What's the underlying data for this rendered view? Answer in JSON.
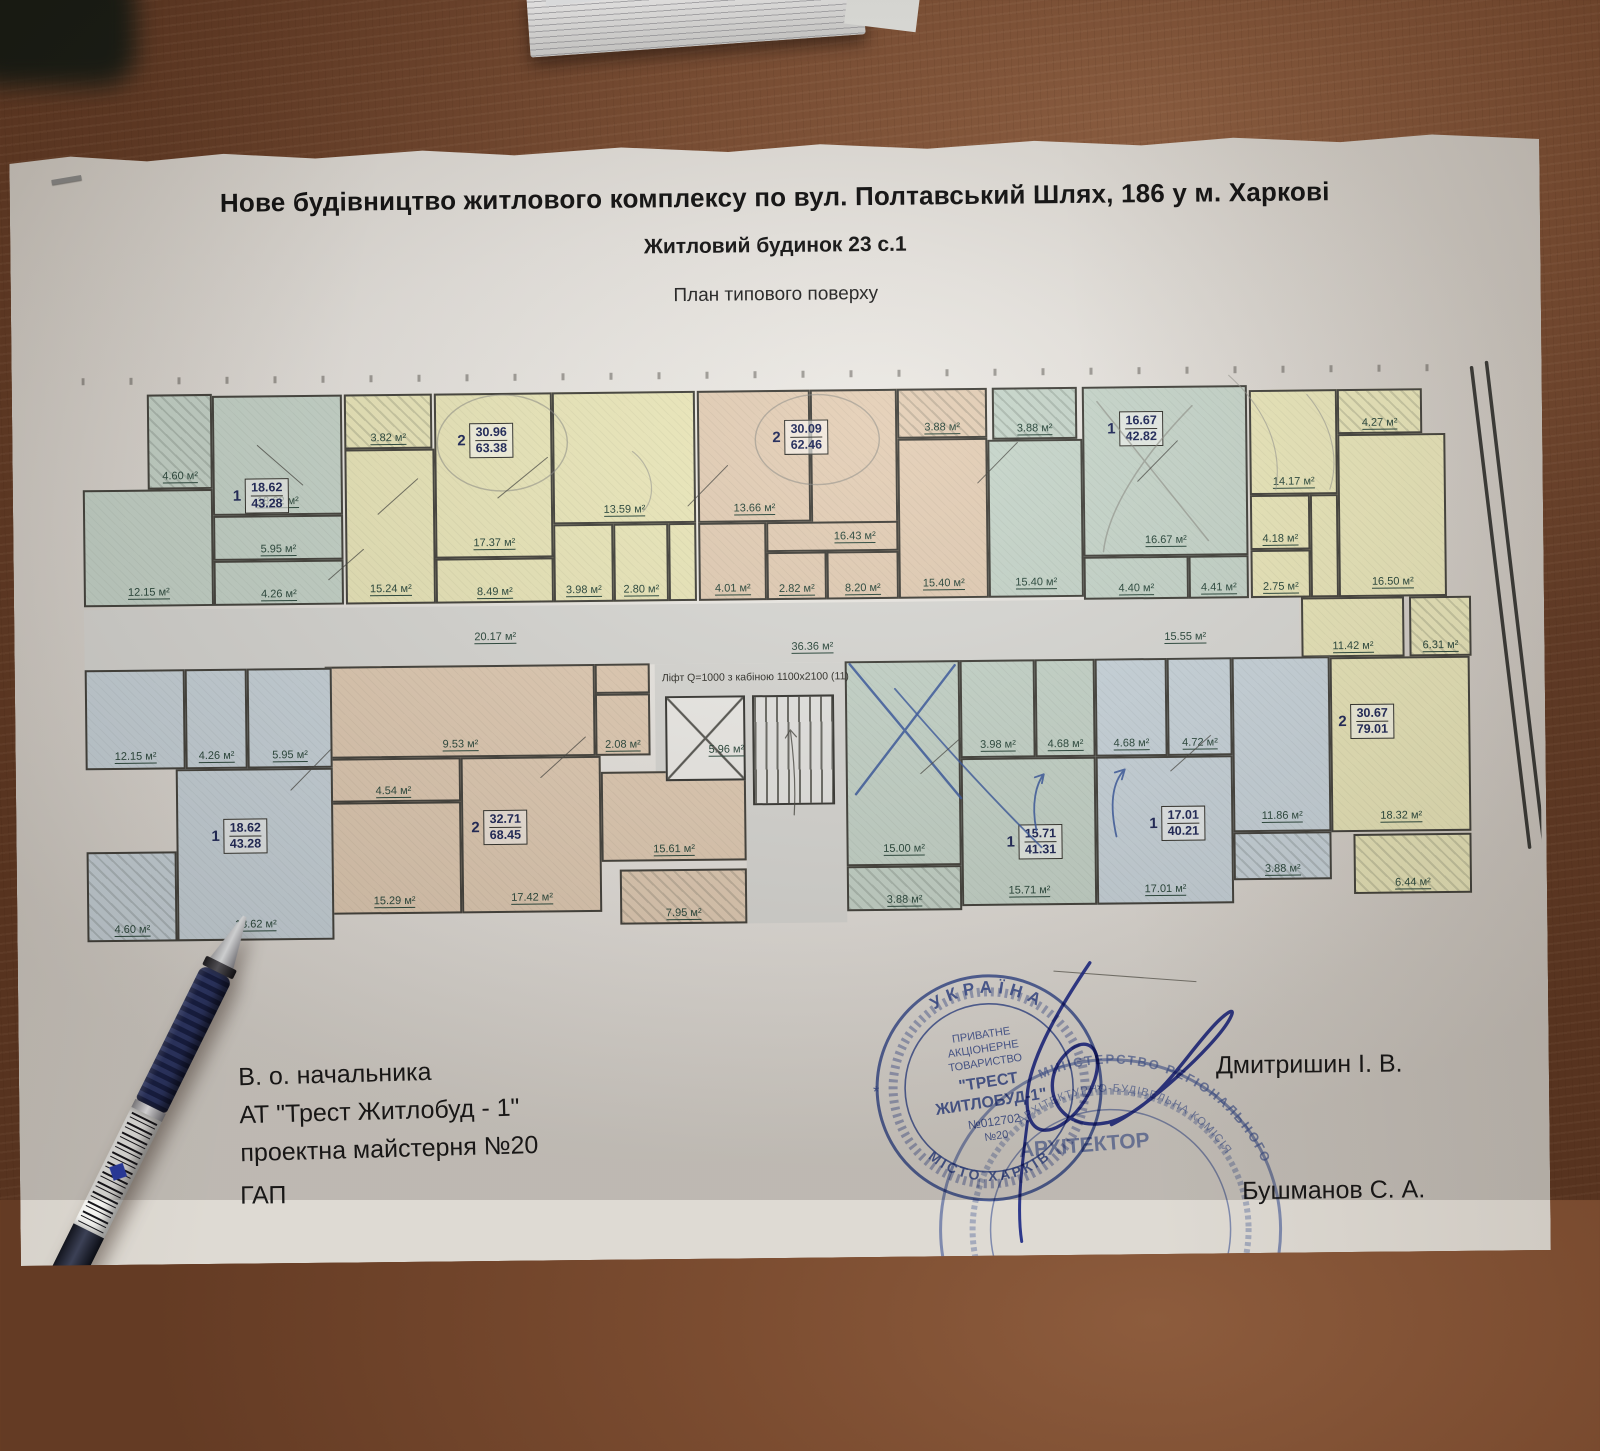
{
  "titles": {
    "line1": "Нове будівництво житлового комплексу по вул. Полтавський Шлях, 186 у м. Харкові",
    "line2": "Житловий будинок 23 с.1",
    "line3": "План типового поверху"
  },
  "plan": {
    "unit": "м²",
    "elevator_note": "Ліфт Q=1000 з кабіною 1100х2100  (11)",
    "rooms": [
      {
        "a": "",
        "x": 5,
        "y": 258,
        "w": 1215,
        "h": 60,
        "c": "gr"
      },
      {
        "a": "",
        "x": 575,
        "y": 318,
        "w": 190,
        "h": 110,
        "c": "gr"
      },
      {
        "a": "",
        "x": 665,
        "y": 428,
        "w": 100,
        "h": 150,
        "c": "gr"
      },
      {
        "a": "4.60",
        "x": 70,
        "y": 43,
        "w": 65,
        "h": 95,
        "c": "g h"
      },
      {
        "a": "18.62",
        "x": 135,
        "y": 45,
        "w": 130,
        "h": 120,
        "c": "g"
      },
      {
        "a": "5.95",
        "x": 135,
        "y": 165,
        "w": 130,
        "h": 45,
        "c": "g"
      },
      {
        "a": "4.26",
        "x": 135,
        "y": 210,
        "w": 130,
        "h": 45,
        "c": "g"
      },
      {
        "a": "12.15",
        "x": 5,
        "y": 138,
        "w": 130,
        "h": 117,
        "c": "g"
      },
      {
        "a": "3.82",
        "x": 267,
        "y": 45,
        "w": 88,
        "h": 55,
        "c": "y h"
      },
      {
        "a": "17.37",
        "x": 357,
        "y": 45,
        "w": 118,
        "h": 165,
        "c": "y"
      },
      {
        "a": "13.59",
        "x": 475,
        "y": 45,
        "w": 143,
        "h": 132,
        "c": "y"
      },
      {
        "a": "15.24",
        "x": 267,
        "y": 100,
        "w": 90,
        "h": 155,
        "c": "y"
      },
      {
        "a": "8.49",
        "x": 357,
        "y": 210,
        "w": 118,
        "h": 45,
        "c": "y"
      },
      {
        "a": "3.98",
        "x": 475,
        "y": 177,
        "w": 60,
        "h": 78,
        "c": "y"
      },
      {
        "a": "2.80",
        "x": 535,
        "y": 177,
        "w": 55,
        "h": 78,
        "c": "y"
      },
      {
        "a": "",
        "x": 590,
        "y": 177,
        "w": 28,
        "h": 78,
        "c": "y"
      },
      {
        "a": "13.66",
        "x": 620,
        "y": 45,
        "w": 113,
        "h": 132,
        "c": "t"
      },
      {
        "a": "16.43",
        "x": 733,
        "y": 45,
        "w": 87,
        "h": 162,
        "c": "t"
      },
      {
        "a": "4.01",
        "x": 620,
        "y": 177,
        "w": 68,
        "h": 78,
        "c": "t"
      },
      {
        "a": "",
        "x": 688,
        "y": 177,
        "w": 132,
        "h": 30,
        "c": "t"
      },
      {
        "a": "2.82",
        "x": 688,
        "y": 207,
        "w": 60,
        "h": 48,
        "c": "t"
      },
      {
        "a": "8.20",
        "x": 748,
        "y": 207,
        "w": 72,
        "h": 48,
        "c": "t"
      },
      {
        "a": "3.88",
        "x": 820,
        "y": 45,
        "w": 90,
        "h": 50,
        "c": "t h"
      },
      {
        "a": "15.40",
        "x": 820,
        "y": 95,
        "w": 90,
        "h": 160,
        "c": "t"
      },
      {
        "a": "3.88",
        "x": 915,
        "y": 45,
        "w": 85,
        "h": 52,
        "c": "g h"
      },
      {
        "a": "16.67",
        "x": 1005,
        "y": 45,
        "w": 165,
        "h": 170,
        "c": "g"
      },
      {
        "a": "15.40",
        "x": 910,
        "y": 97,
        "w": 95,
        "h": 158,
        "c": "g"
      },
      {
        "a": "4.40",
        "x": 1005,
        "y": 215,
        "w": 105,
        "h": 43,
        "c": "g"
      },
      {
        "a": "4.41",
        "x": 1110,
        "y": 215,
        "w": 60,
        "h": 43,
        "c": "g"
      },
      {
        "a": "14.17",
        "x": 1172,
        "y": 50,
        "w": 88,
        "h": 105,
        "c": "y"
      },
      {
        "a": "4.27",
        "x": 1260,
        "y": 50,
        "w": 85,
        "h": 45,
        "c": "y h"
      },
      {
        "a": "16.50",
        "x": 1260,
        "y": 95,
        "w": 108,
        "h": 163,
        "c": "y"
      },
      {
        "a": "4.18",
        "x": 1172,
        "y": 155,
        "w": 60,
        "h": 55,
        "c": "y"
      },
      {
        "a": "2.75",
        "x": 1172,
        "y": 210,
        "w": 60,
        "h": 48,
        "c": "y"
      },
      {
        "a": "",
        "x": 1232,
        "y": 155,
        "w": 28,
        "h": 103,
        "c": "y"
      },
      {
        "a": "11.42",
        "x": 1222,
        "y": 258,
        "w": 103,
        "h": 60,
        "c": "y"
      },
      {
        "a": "6.31",
        "x": 1330,
        "y": 258,
        "w": 62,
        "h": 60,
        "c": "y h"
      },
      {
        "a": "18.32",
        "x": 1250,
        "y": 318,
        "w": 140,
        "h": 175,
        "c": "y"
      },
      {
        "a": "6.44",
        "x": 1272,
        "y": 495,
        "w": 118,
        "h": 60,
        "c": "y h"
      },
      {
        "a": "4.68",
        "x": 1015,
        "y": 317,
        "w": 72,
        "h": 98,
        "c": "b"
      },
      {
        "a": "4.72",
        "x": 1087,
        "y": 317,
        "w": 65,
        "h": 98,
        "c": "b"
      },
      {
        "a": "17.01",
        "x": 1015,
        "y": 415,
        "w": 137,
        "h": 148,
        "c": "b"
      },
      {
        "a": "11.86",
        "x": 1152,
        "y": 317,
        "w": 98,
        "h": 175,
        "c": "b"
      },
      {
        "a": "3.88",
        "x": 1152,
        "y": 492,
        "w": 98,
        "h": 48,
        "c": "b h"
      },
      {
        "a": "15.00",
        "x": 765,
        "y": 317,
        "w": 115,
        "h": 205,
        "c": "g"
      },
      {
        "a": "3.98",
        "x": 880,
        "y": 317,
        "w": 75,
        "h": 98,
        "c": "g"
      },
      {
        "a": "4.68",
        "x": 955,
        "y": 317,
        "w": 60,
        "h": 98,
        "c": "g"
      },
      {
        "a": "15.71",
        "x": 880,
        "y": 415,
        "w": 135,
        "h": 148,
        "c": "g"
      },
      {
        "a": "3.88",
        "x": 765,
        "y": 522,
        "w": 115,
        "h": 45,
        "c": "g h"
      },
      {
        "a": "9.53",
        "x": 245,
        "y": 317,
        "w": 270,
        "h": 92,
        "c": "t"
      },
      {
        "a": "4.54",
        "x": 245,
        "y": 409,
        "w": 135,
        "h": 44,
        "c": "t"
      },
      {
        "a": "15.29",
        "x": 245,
        "y": 453,
        "w": 135,
        "h": 112,
        "c": "t"
      },
      {
        "a": "17.42",
        "x": 380,
        "y": 409,
        "w": 140,
        "h": 156,
        "c": "t"
      },
      {
        "a": "",
        "x": 515,
        "y": 317,
        "w": 55,
        "h": 30,
        "c": "t"
      },
      {
        "a": "2.08",
        "x": 515,
        "y": 347,
        "w": 55,
        "h": 62,
        "c": "t"
      },
      {
        "a": "15.61",
        "x": 520,
        "y": 425,
        "w": 145,
        "h": 90,
        "c": "t"
      },
      {
        "a": "7.95",
        "x": 538,
        "y": 523,
        "w": 127,
        "h": 55,
        "c": "t h"
      },
      {
        "a": "4.26",
        "x": 105,
        "y": 318,
        "w": 62,
        "h": 100,
        "c": "b"
      },
      {
        "a": "12.15",
        "x": 5,
        "y": 318,
        "w": 100,
        "h": 100,
        "c": "b"
      },
      {
        "a": "5.95",
        "x": 167,
        "y": 318,
        "w": 85,
        "h": 100,
        "c": "b"
      },
      {
        "a": "18.62",
        "x": 95,
        "y": 418,
        "w": 157,
        "h": 172,
        "c": "b"
      },
      {
        "a": "4.60",
        "x": 5,
        "y": 500,
        "w": 90,
        "h": 90,
        "c": "b h"
      },
      {
        "a": "",
        "x": 585,
        "y": 350,
        "w": 80,
        "h": 85,
        "c": "wh"
      },
      {
        "a": "",
        "x": 672,
        "y": 350,
        "w": 82,
        "h": 110,
        "c": "st"
      }
    ],
    "tags": [
      {
        "n": "1",
        "top": "18.62",
        "bot": "43.28",
        "x": 155,
        "y": 128
      },
      {
        "n": "2",
        "top": "30.96",
        "bot": "63.38",
        "x": 380,
        "y": 75
      },
      {
        "n": "2",
        "top": "30.09",
        "bot": "62.46",
        "x": 695,
        "y": 75
      },
      {
        "n": "1",
        "top": "16.67",
        "bot": "42.82",
        "x": 1030,
        "y": 70
      },
      {
        "n": "2",
        "top": "30.67",
        "bot": "79.01",
        "x": 1258,
        "y": 365
      },
      {
        "n": "1",
        "top": "17.01",
        "bot": "40.21",
        "x": 1068,
        "y": 465
      },
      {
        "n": "1",
        "top": "15.71",
        "bot": "41.31",
        "x": 925,
        "y": 482
      },
      {
        "n": "2",
        "top": "32.71",
        "bot": "68.45",
        "x": 390,
        "y": 462
      },
      {
        "n": "1",
        "top": "18.62",
        "bot": "43.28",
        "x": 130,
        "y": 468
      }
    ],
    "labels": [
      {
        "t": "20.17",
        "x": 395,
        "y": 283
      },
      {
        "t": "36.36",
        "x": 712,
        "y": 296
      },
      {
        "t": "15.55",
        "x": 1085,
        "y": 290
      },
      {
        "t": "5.96",
        "x": 628,
        "y": 398
      }
    ]
  },
  "footer": {
    "l1": "В. о. начальника",
    "l2": "АТ \"Трест Житлобуд - 1\"",
    "l3": "проектна майстерня №20",
    "gap": "ГАП",
    "name1": "Дмитришин І. В.",
    "name2": "Бушманов С. А."
  },
  "stamp1": {
    "outer_top": "УКРАЇНА",
    "outer_bottom": "МІСТО ХАРКІВ",
    "i1": "ПРИВАТНЕ",
    "i2": "АКЦІОНЕРНЕ",
    "i3": "ТОВАРИСТВО",
    "i4": "\"ТРЕСТ",
    "i5": "ЖИТЛОБУД-1\"",
    "i6": "№012702",
    "i7": "№20",
    "color": "#3952a6"
  },
  "stamp2": {
    "arc1": "МІНІСТЕРСТВО РЕГІОНАЛЬНОГО",
    "arc2": "АРХІТЕКТУРНО-БУДІВЕЛЬНА КОМІСІЯ",
    "title": "АРХІТЕКТОР",
    "color": "#4a64b4"
  }
}
